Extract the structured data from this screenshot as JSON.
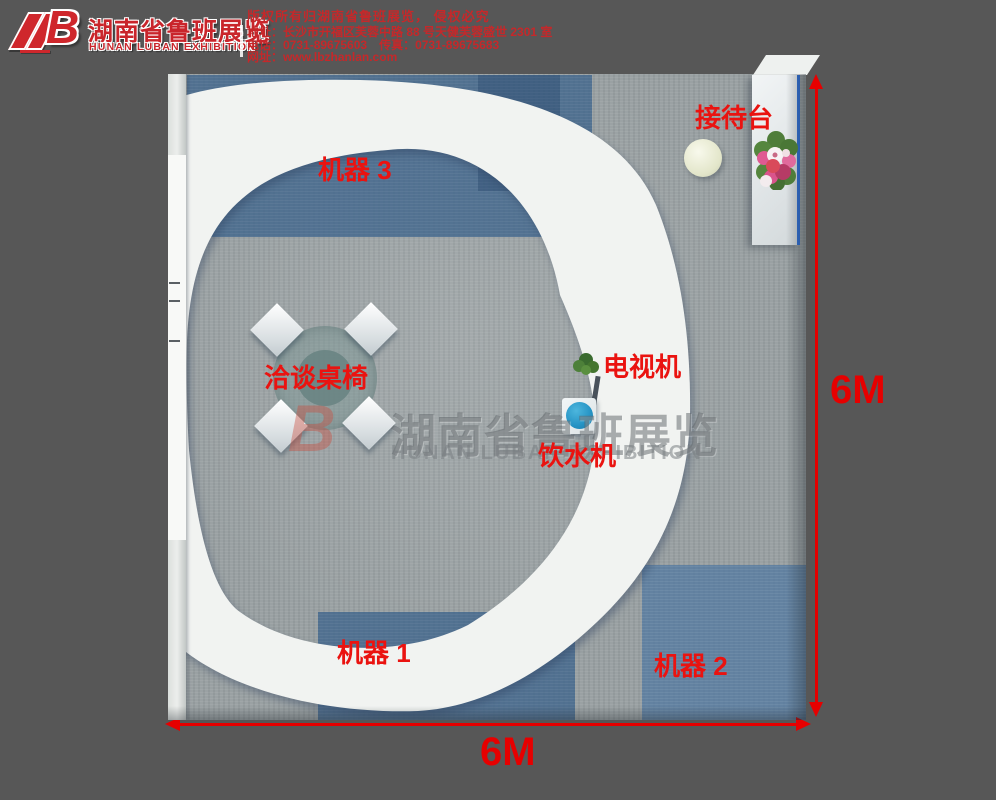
{
  "header": {
    "logo_mark": "B",
    "brand_cn": "湖南省鲁班展览",
    "brand_en": "HUNAN LUBAN EXHIBITION",
    "info_lines": [
      "版权所有归湖南省鲁班展览， 侵权必究",
      "地址：长沙市开福区芙蓉中路 88 号天健芙蓉盛世 2301 室",
      "电话：0731-89675603　传真：0731-89675683",
      "网址：www.lbzhanlan.com"
    ]
  },
  "floorplan": {
    "labels": {
      "reception": "接待台",
      "machine3": "机器 3",
      "negotiation_table": "洽谈桌椅",
      "tv": "电视机",
      "water_dispenser": "饮水机",
      "machine1": "机器 1",
      "machine2": "机器 2"
    },
    "dimensions": {
      "width": "6M",
      "height": "6M"
    },
    "watermark": {
      "mark": "B",
      "cn": "湖南省鲁班展览",
      "en": "HUNAN LUBAN EXHIBITION"
    },
    "colors": {
      "accent_red": "#ea1310",
      "dimension_red": "#e60000",
      "header_red": "#c9252b",
      "carpet_gray": "#9aa1a3",
      "carpet_blue": "#5d82a4",
      "structure_white": "#f1f3f1",
      "desk_edge_blue": "#2f6fd6",
      "dispenser_blue": "#2593c4",
      "background_gray": "#575757"
    }
  }
}
